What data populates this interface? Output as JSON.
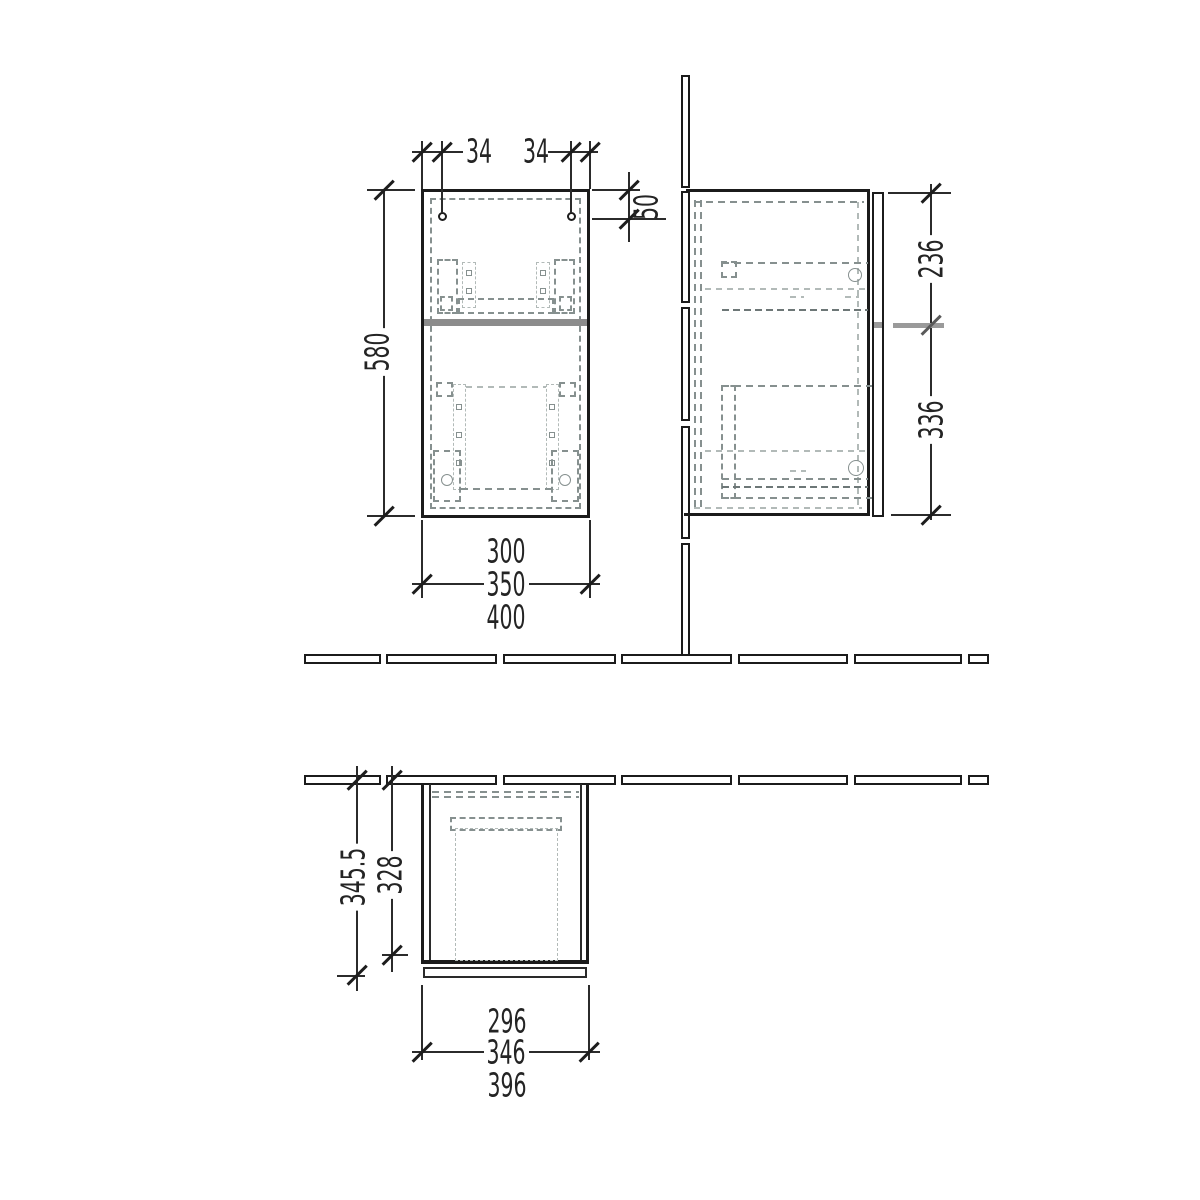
{
  "views": {
    "front": {
      "hole_spacing_left": "34",
      "hole_spacing_right": "34",
      "hole_top_offset": "50",
      "height": "580",
      "width_inner": "300",
      "width_carcass": "350",
      "width_overall": "400"
    },
    "side": {
      "upper_section": "236",
      "lower_section": "336"
    },
    "plan": {
      "depth_overall": "345.5",
      "depth_inner": "328",
      "width_inner": "296",
      "width_carcass": "346",
      "width_overall": "396"
    }
  },
  "colors": {
    "line": "#1b1b1b",
    "divider_gray": "#8c8c8c",
    "tick_gray": "#9a9a9a",
    "dash_gray": "#86908f"
  }
}
